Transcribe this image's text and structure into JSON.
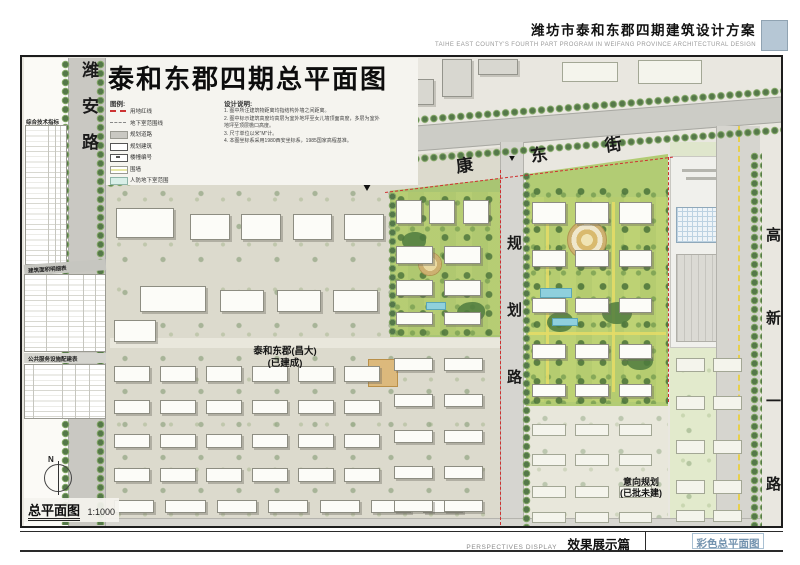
{
  "header": {
    "title": "潍坊市泰和东郡四期建筑设计方案",
    "subtitle": "TAIHE EAST COUNTY'S FOURTH PART PROGRAM IN WEIFANG PROVINCE   ARCHITECTURAL DESIGN"
  },
  "sheet": {
    "title": "泰和东郡四期总平面图",
    "legend": {
      "title": "图例:",
      "items": [
        {
          "label": "用地红线"
        },
        {
          "label": "地下室范围线"
        },
        {
          "label": "规划道路"
        },
        {
          "label": "规划建筑"
        },
        {
          "label": "楼幢编号"
        },
        {
          "label": "围墙"
        },
        {
          "label": "人防地下室范围"
        }
      ]
    },
    "notes": {
      "title": "设计说明:",
      "lines": [
        "1. 图中所注建筑物距离均指结构外墙之间距离。",
        "2. 图中标示建筑高度均高层为室外地坪至女儿墙顶面高度，多层为室外地坪至顶层檐口高度。",
        "3. 尺寸单位以米\"M\"计。",
        "4. 本图坐标系采用1980西安坐标系，1985国家高程基准。"
      ]
    },
    "tables": {
      "t1": "综合技术指标",
      "t2": "建筑面积明细表",
      "t3": "公共服务设施配建表"
    },
    "roads": {
      "west": "潍安路",
      "north": "健康东街",
      "middle": "规划路",
      "east": "高新一路"
    },
    "labels": {
      "existing_line1": "泰和东郡(昌大)",
      "existing_line2": "(已建成)",
      "planned_line1": "意向规划",
      "planned_line2": "(已批未建)",
      "entrance": "主入口"
    },
    "scale": {
      "name": "总平面图",
      "ratio": "1:1000"
    },
    "compass": "N"
  },
  "footer": {
    "series_en": "PERSPECTIVES DISPLAY",
    "series_cn": "效果展示篇",
    "sheet_name": "彩色总平面图"
  },
  "colors": {
    "accent_blue": "#7c99b4",
    "red_line": "#cf3030",
    "road_gray": "#c9c8c2",
    "tree_green": "#55784a",
    "lawn_green": "#c5d66b"
  }
}
